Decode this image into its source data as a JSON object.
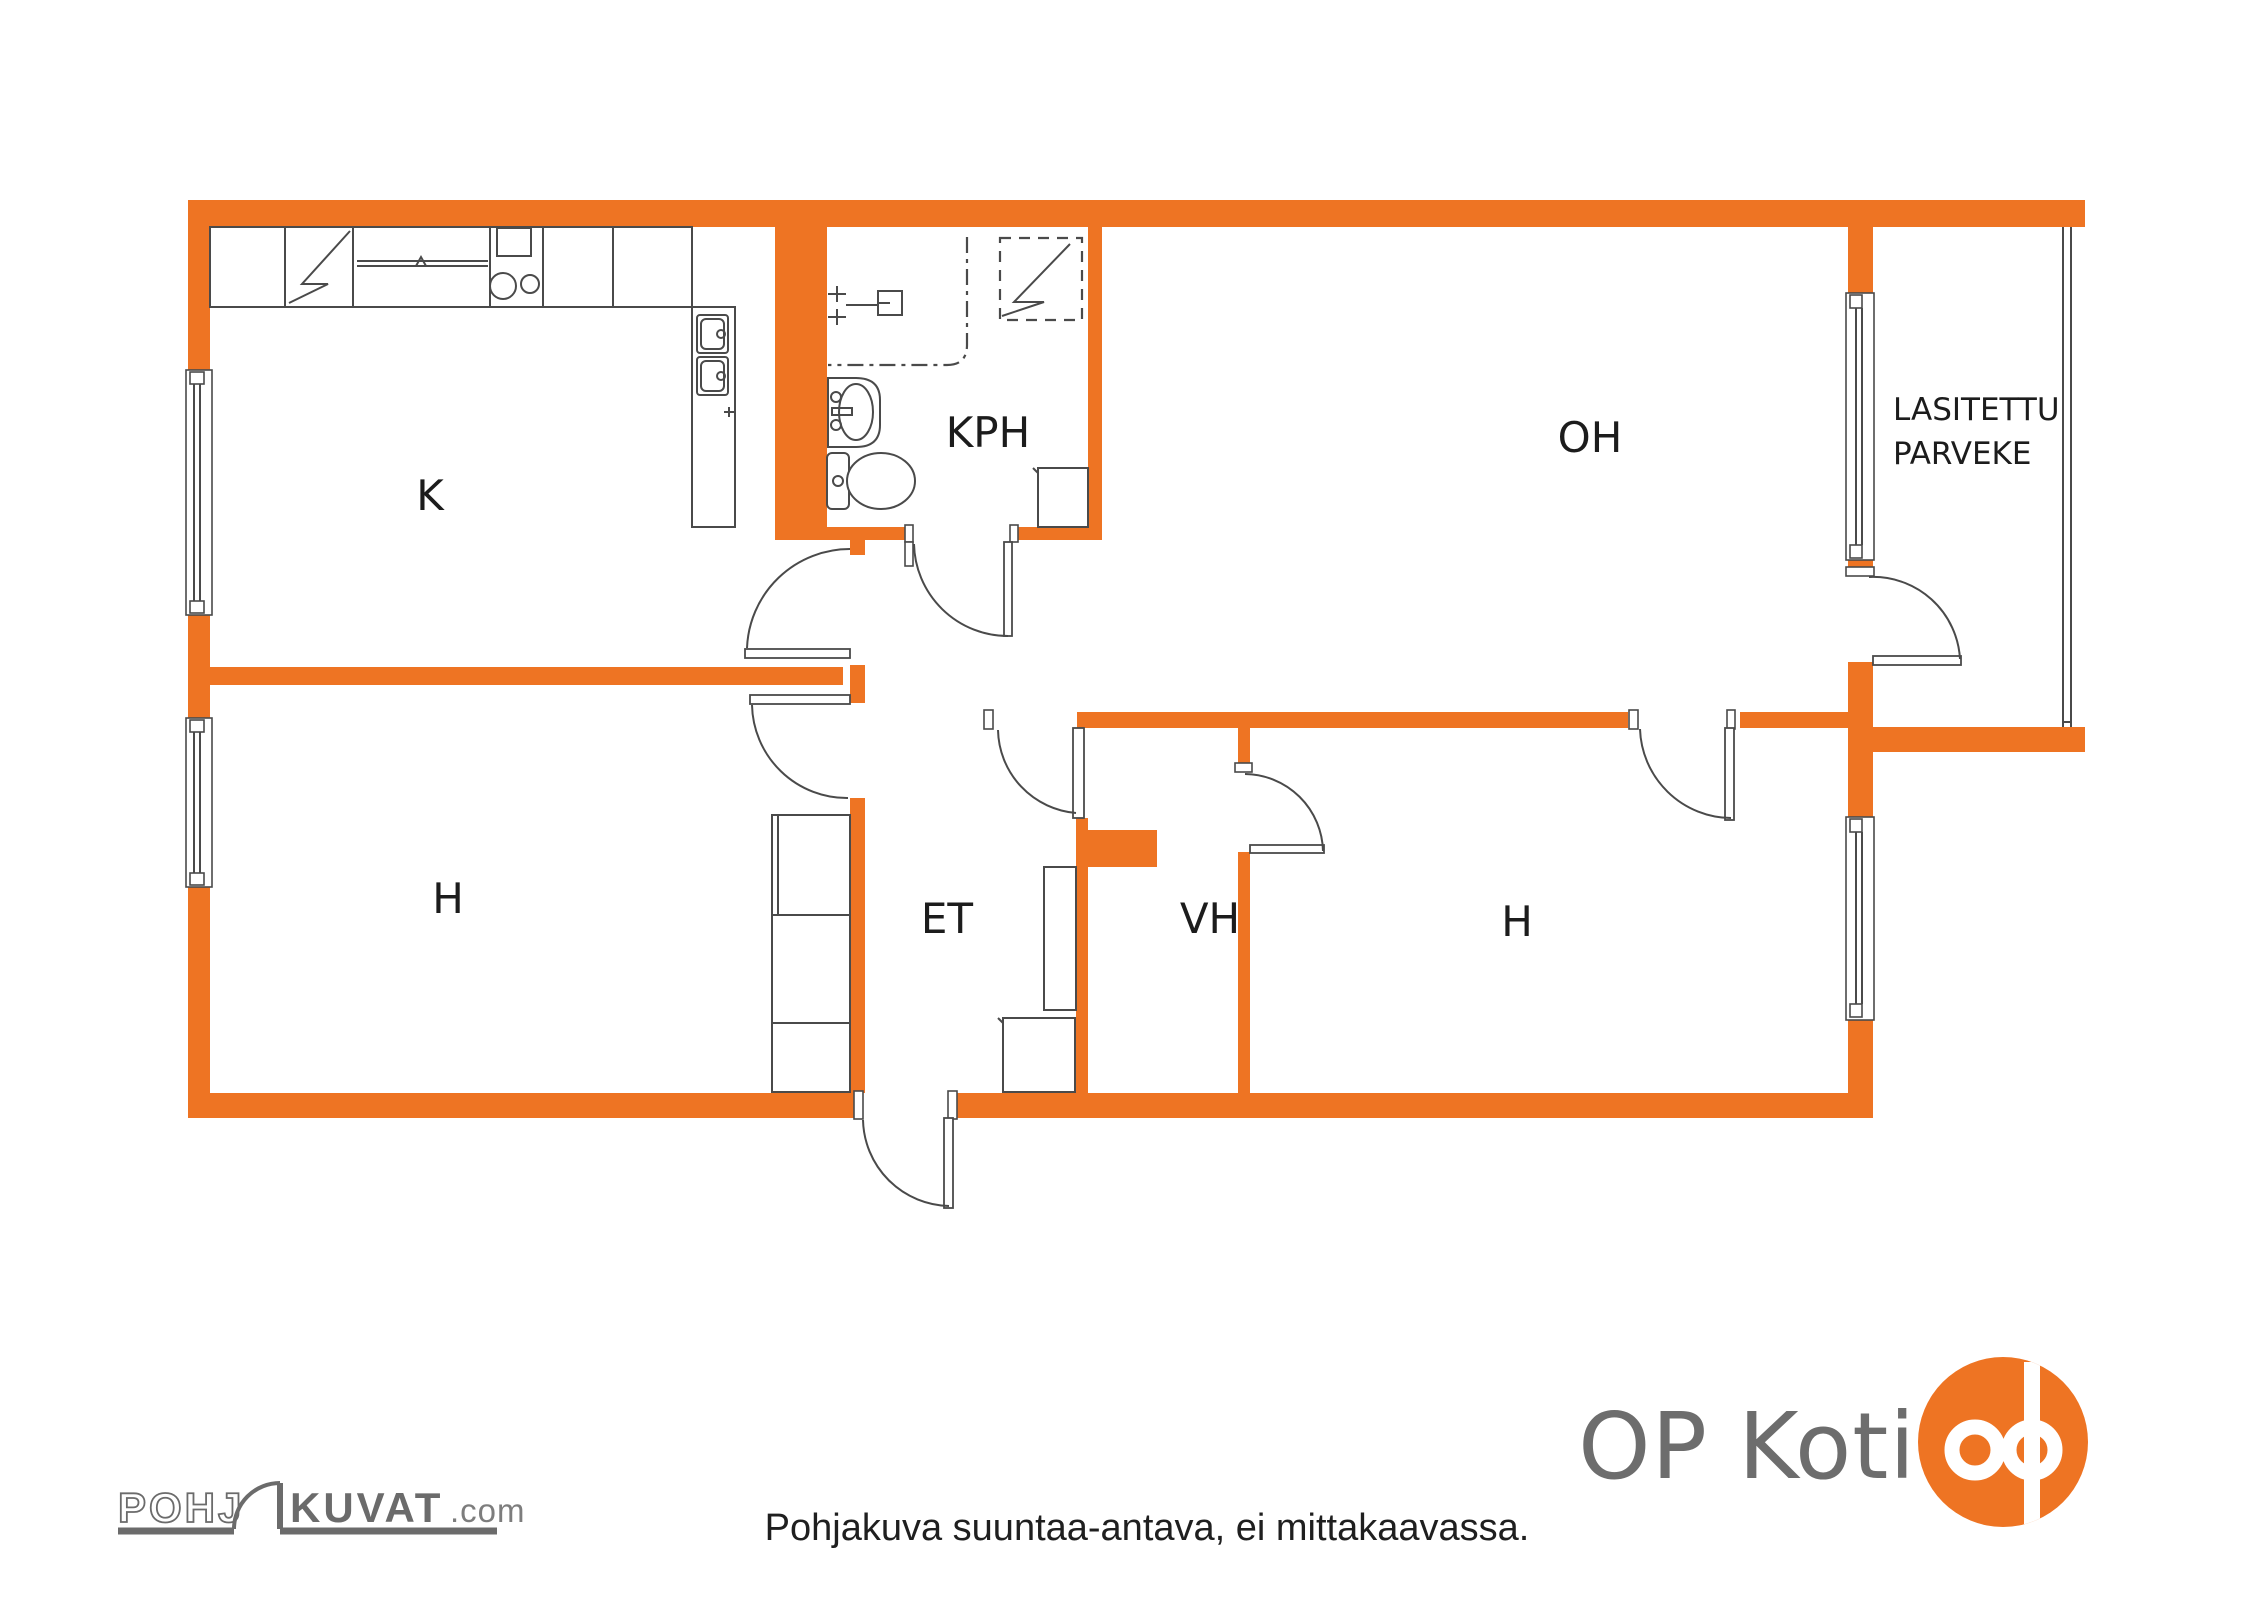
{
  "floor_plan": {
    "colors": {
      "wall_orange": "#EE7423",
      "line_gray": "#4a4a4a",
      "label_black": "#1c1c1c"
    },
    "rooms": {
      "kitchen": {
        "label": "K"
      },
      "bathroom": {
        "label": "KPH"
      },
      "living_room": {
        "label": "OH"
      },
      "balcony": {
        "label_line1": "LASITETTU",
        "label_line2": "PARVEKE"
      },
      "bedroom_left": {
        "label": "H"
      },
      "entry_hall": {
        "label": "ET"
      },
      "walk_in_closet": {
        "label": "VH"
      },
      "bedroom_right": {
        "label": "H"
      }
    }
  },
  "footer": {
    "disclaimer": "Pohjakuva suuntaa-antava, ei mittakaavassa."
  },
  "branding": {
    "op_koti": {
      "wordmark": "OP Koti",
      "text_color": "#6d6d6d",
      "logo_color": "#EE7423"
    },
    "pohjakuvat": {
      "word_outline": "POHJ",
      "word_solid": "KUVAT",
      "suffix": ".com",
      "color": "#6b6b6b"
    }
  }
}
